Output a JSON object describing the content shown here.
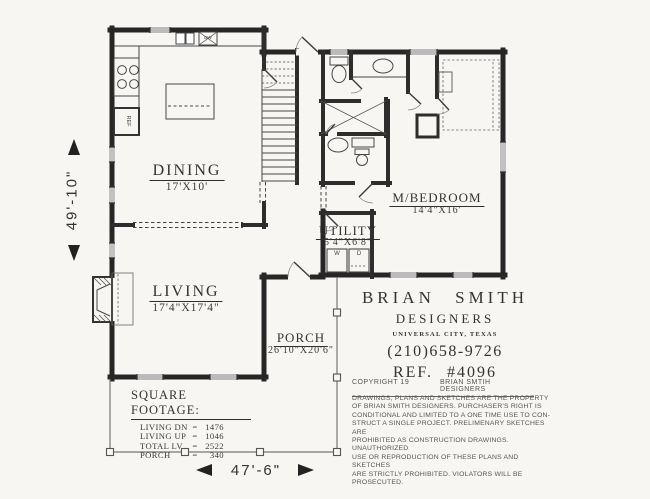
{
  "rooms": {
    "dining": {
      "name": "DINING",
      "size": "17'X10'"
    },
    "living": {
      "name": "LIVING",
      "size": "17'4\"X17'4\""
    },
    "mbedroom": {
      "name": "M/BEDROOM",
      "size": "14'4\"X16'"
    },
    "utility": {
      "name": "UTILITY",
      "size": "5'4\"X6'8\""
    },
    "porch": {
      "name": "PORCH",
      "size": "26'10\"X20'6\""
    }
  },
  "fixtures": {
    "washer": "W",
    "dryer": "D",
    "refrigerator": "REF",
    "dishwasher": "DW"
  },
  "dimensions": {
    "height_label": "49'-10\"",
    "width_label": "47'-6\""
  },
  "square_footage": {
    "title": "SQUARE FOOTAGE:",
    "rows": [
      {
        "label": "LIVING DN",
        "eq": "=",
        "value": "1476"
      },
      {
        "label": "LIVING UP",
        "eq": "=",
        "value": "1046"
      },
      {
        "label": "TOTAL LV",
        "eq": "=",
        "value": "2522"
      },
      {
        "label": "PORCH",
        "eq": "=",
        "value": "340"
      }
    ]
  },
  "title_block": {
    "firm_line1": "BRIAN SMITH",
    "firm_line2": "DESIGNERS",
    "location": "UNIVERSAL CITY, TEXAS",
    "phone": "(210)658-9726",
    "ref": "REF. #4096",
    "copyright_left": "COPYRIGHT 19",
    "copyright_right": "BRIAN SMTIH DESIGNERS",
    "legal_lines": [
      "DRAWINGS, PLANS AND SKETCHES ARE THE PROPERTY",
      "OF BRIAN SMITH DESIGNERS.  PURCHASER'S RIGHT IS",
      "CONDITIONAL AND LIMITED TO A ONE TIME USE TO CON-",
      "STRUCT A SINGLE PROJECT.  PRELIMENARY SKETCHES ARE",
      "PROHIBITED AS CONSTRUCTION DRAWINGS.  UNAUTHORIZED",
      "USE OR REPRODUCTION OF THESE PLANS AND SKETCHES",
      "ARE STRICTLY PROHIBITED.  VIOLATORS WILL BE PROSECUTED."
    ]
  }
}
